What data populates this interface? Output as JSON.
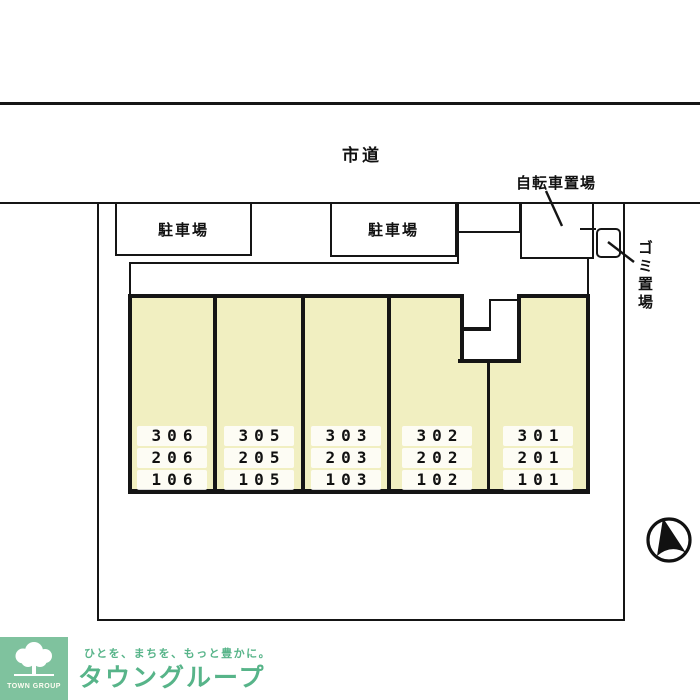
{
  "plan": {
    "road_label": "市道",
    "bicycle_parking_label": "自転車置場",
    "garbage_label": "ゴミ置場",
    "parking_label_1": "駐車場",
    "parking_label_2": "駐車場",
    "units": [
      {
        "floor3": "306",
        "floor2": "206",
        "floor1": "106"
      },
      {
        "floor3": "305",
        "floor2": "205",
        "floor1": "105"
      },
      {
        "floor3": "303",
        "floor2": "203",
        "floor1": "103"
      },
      {
        "floor3": "302",
        "floor2": "202",
        "floor1": "102"
      },
      {
        "floor3": "301",
        "floor2": "201",
        "floor1": "101"
      }
    ]
  },
  "footer": {
    "logo_box_label": "TOWN GROUP",
    "tagline": "ひとを、まちを、もっと豊かに。",
    "brand_name": "タウングループ"
  },
  "colors": {
    "building_fill": "#f1efc1",
    "line_black": "#151515",
    "brand_green": "#57b489",
    "logo_box_green": "#7fc29e"
  },
  "icons": {
    "compass": "north-arrow-compass-icon",
    "tree": "town-group-tree-icon"
  }
}
